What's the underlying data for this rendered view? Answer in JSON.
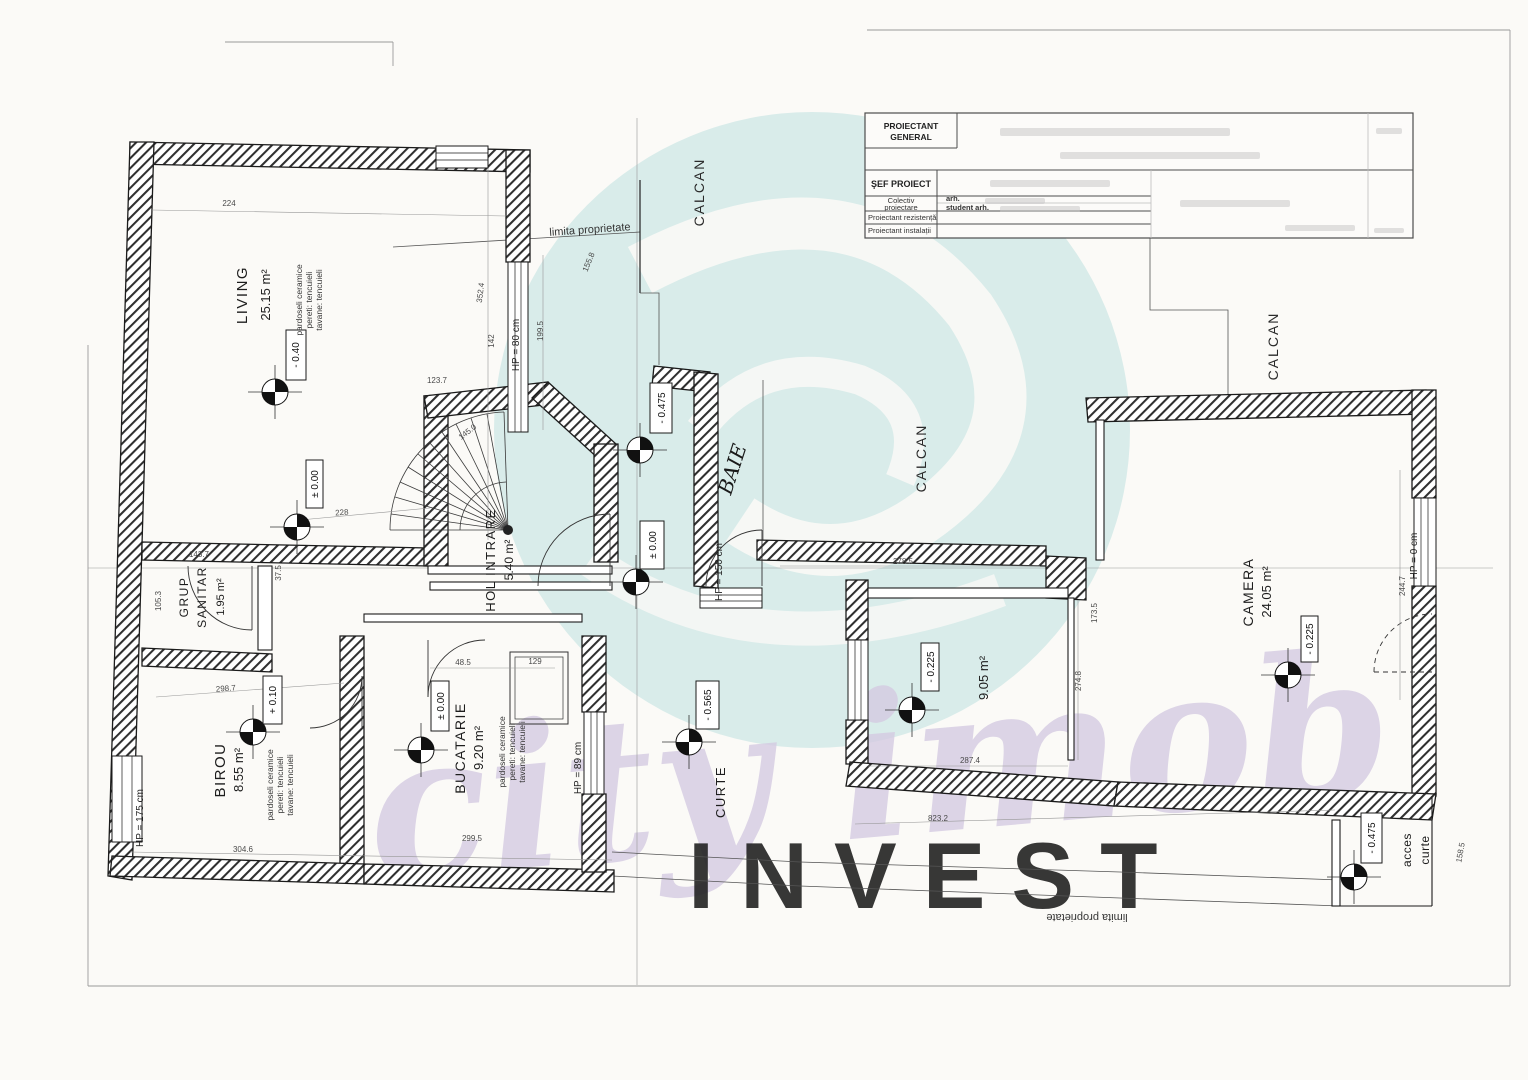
{
  "watermark": {
    "script": "city imob",
    "invest": "INVEST",
    "teal_circle": "#d9ecea",
    "script_purple": "#d5cbe2",
    "invest_teal": "#c8eae7"
  },
  "title_block": {
    "pg1": "PROIECTANT",
    "pg2": "GENERAL",
    "sef_proiect": "ŞEF PROIECT",
    "colectiv1": "Colectiv",
    "colectiv2": "proiectare",
    "arh": "arh.",
    "student_arh": "student arh.",
    "rezistenta": "Proiectant rezistență",
    "instalatii": "Proiectant instalații"
  },
  "labels": {
    "calcan": "CALCAN",
    "limita_top": "limita proprietate",
    "limita_bottom": "limita proprietate"
  },
  "rooms": {
    "living": {
      "name": "LIVING",
      "area": "25.15 m²",
      "f1": "pardoseli ceramice",
      "f2": "pereti: tencuieli",
      "f3": "tavane: tencuieli"
    },
    "grup": {
      "name": "GRUP",
      "name2": "SANITAR",
      "area": "1.95 m²"
    },
    "birou": {
      "name": "BIROU",
      "area": "8.55 m²",
      "f1": "pardoseli ceramice",
      "f2": "pereti: tencuieli",
      "f3": "tavane: tencuieli"
    },
    "bucatarie": {
      "name": "BUCATARIE",
      "area": "9.20 m²",
      "f1": "pardoseli ceramice",
      "f2": "pereti: tencuieli",
      "f3": "tavane: tencuieli"
    },
    "hol": {
      "name": "HOL INTRARE",
      "area": "5.40 m²"
    },
    "baie": {
      "name": "BAIE"
    },
    "curte": {
      "name": "CURTE"
    },
    "room905": {
      "area": "9.05 m²"
    },
    "camera": {
      "name": "CAMERA",
      "area": "24.05 m²"
    },
    "acces": {
      "name": "acces",
      "name2": "curte"
    }
  },
  "levels": {
    "living": "- 0.40",
    "hol": "± 0.00",
    "birou": "+ 0.10",
    "bucatarie": "± 0.00",
    "baie_top": "- 0.475",
    "baie": "± 0.00",
    "curte": "- 0.565",
    "room905": "- 0.225",
    "camera": "- 0.225",
    "acces": "- 0.475"
  },
  "hp": {
    "living": "HP = 80 cm",
    "birou": "HP = 175 cm",
    "bucatarie": "HP = 89 cm",
    "baie": "HP = 150 cm",
    "camera": "HP = 0 cm"
  },
  "dims": [
    {
      "t": "224"
    },
    {
      "t": "123.7"
    },
    {
      "t": "145.0"
    },
    {
      "t": "352.4"
    },
    {
      "t": "142"
    },
    {
      "t": "199.5"
    },
    {
      "t": "155.8"
    },
    {
      "t": "143.7"
    },
    {
      "t": "105.3"
    },
    {
      "t": "37.5"
    },
    {
      "t": "298.7"
    },
    {
      "t": "304.6"
    },
    {
      "t": "299.5"
    },
    {
      "t": "48.5"
    },
    {
      "t": "129"
    },
    {
      "t": "228"
    },
    {
      "t": "278.5"
    },
    {
      "t": "287.4"
    },
    {
      "t": "274.8"
    },
    {
      "t": "823.2"
    },
    {
      "t": "244.7"
    },
    {
      "t": "158.5"
    },
    {
      "t": "173.5"
    }
  ]
}
